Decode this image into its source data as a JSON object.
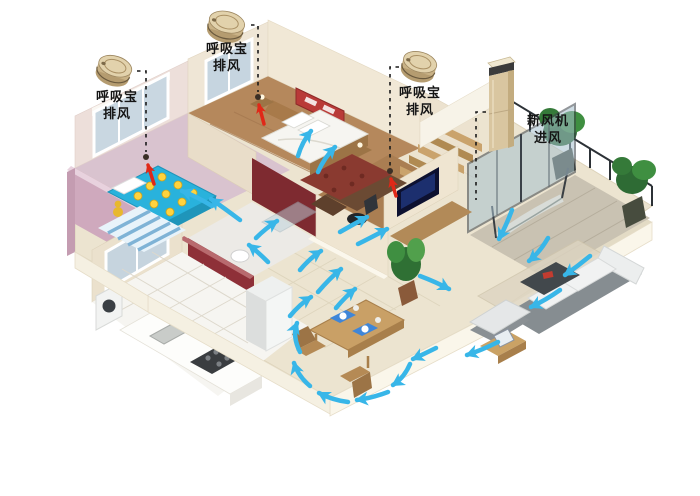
{
  "annotations": {
    "exhaust_units": [
      {
        "icon": "exhaust-fan-puck",
        "line1": "呼吸宝",
        "line2": "排风"
      },
      {
        "icon": "exhaust-fan-puck",
        "line1": "呼吸宝",
        "line2": "排风"
      },
      {
        "icon": "exhaust-fan-puck",
        "line1": "呼吸宝",
        "line2": "排风"
      }
    ],
    "fresh_air_unit": {
      "icon": "fresh-air-tower",
      "line1": "新风机",
      "line2": "进风"
    }
  },
  "colors": {
    "background": "#ffffff",
    "airflow_arrow": "#38b6e8",
    "exhaust_arrow": "#e02818",
    "leader_line": "#1a1a1a",
    "device_gold": "#d9c7a0",
    "wall_cream": "#efe6d4",
    "kids_room_pink": "#d9c3cf",
    "kids_wall_pink": "#cfa9bd",
    "bathroom_maroon": "#8e3038",
    "kids_blanket_blue": "#29b2dc",
    "blanket_dot_yellow": "#ffd33e",
    "master_floor_wood": "#b5885c",
    "tv_screen_blue": "#1c2f6e",
    "sofa_gray": "#868d91",
    "plant_green": "#3f8f41"
  }
}
